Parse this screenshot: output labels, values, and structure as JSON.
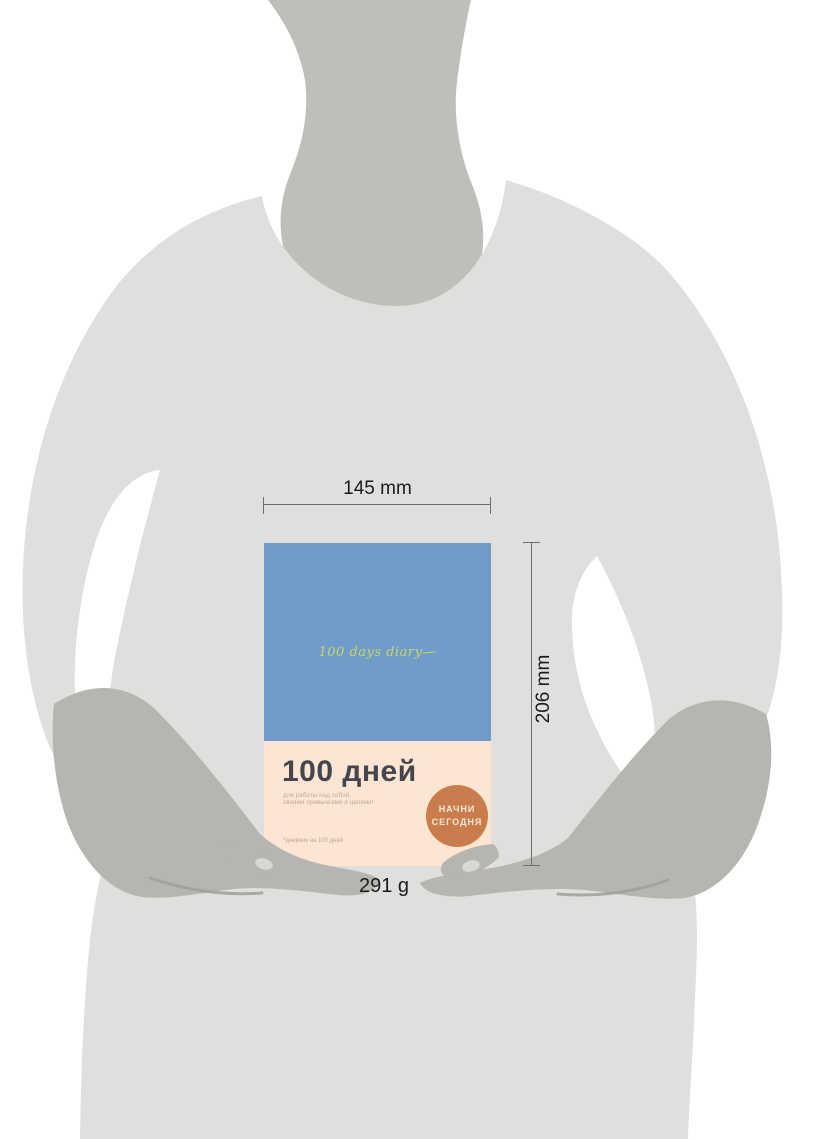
{
  "figure": {
    "type": "product-size-illustration",
    "dimensions": {
      "width_label": "145 mm",
      "height_label": "206 mm",
      "weight_label": "291 g"
    },
    "book": {
      "cover_script": "100 days diary",
      "title": "100 дней",
      "subtitle_line1": "для работы над собой,",
      "subtitle_line2": "своими привычками и целями!",
      "badge_line1": "НАЧНИ",
      "badge_line2": "СЕГОДНЯ",
      "footnote": "*дневник на 100 дней"
    },
    "colors": {
      "cover_blue": "#6f9cc9",
      "cover_peach": "#fce5d3",
      "badge_orange": "#c97c4c",
      "title_dark": "#45454d",
      "script_yellow": "#cdd46e",
      "body_gray": "#e0dfdd",
      "neck_gray": "#bfbeba",
      "hand_gray": "#b6b5b1",
      "dimension_line": "#6e6e6e"
    }
  }
}
